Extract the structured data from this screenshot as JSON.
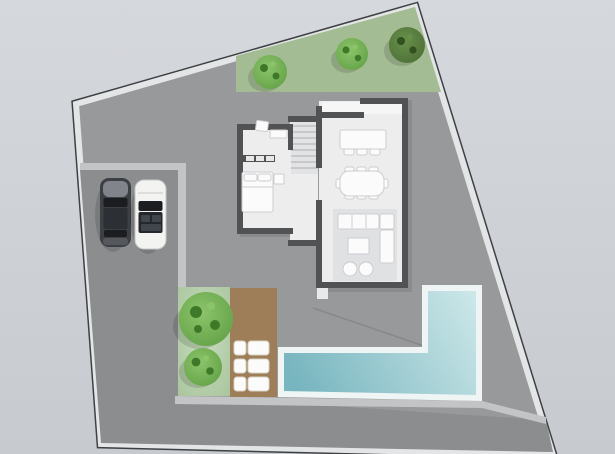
{
  "scene": {
    "name": "residential-site-plan-top-view",
    "plot": "irregular-quadrilateral-parcel",
    "house_rooms": [
      "bathroom",
      "staircase",
      "bedroom",
      "hallway",
      "kitchen",
      "dining-area",
      "living-area"
    ],
    "outdoor_objects": [
      "garden-strip",
      "driveway",
      "walkway",
      "lawn",
      "wood-deck",
      "l-shaped-pool"
    ],
    "tree_count_top_strip": 3,
    "tree_count_lawn": 2,
    "sun_lounger_count": 3,
    "car_count": 2,
    "cars": [
      "dark-car",
      "white-car"
    ]
  },
  "palette": {
    "bg_top": "#d5d8dc",
    "bg_bottom": "#c7cbd0",
    "plot_fill": "#97999b",
    "plot_wall_light": "#e4e5e6",
    "plot_wall_dark": "#3e4144",
    "garden_green": "#a4bc93",
    "lawn_light": "#c8dcbf",
    "lawn_dark": "#a9c59d",
    "tree_base": "#5f9e43",
    "tree_light": "#8cc46a",
    "tree_speck": "#3e7829",
    "dtree_base": "#4a6b34",
    "dtree_light": "#68904b",
    "dtree_speck": "#32501f",
    "driveway": "#8b8d8f",
    "walkway": "#c3c4c6",
    "deck_brown": "#9d7e58",
    "lounger_white": "#fbfbf9",
    "lounger_edge": "#d8d2c6",
    "pool_border": "#eff5f5",
    "water_light": "#cfe9ea",
    "water_deep": "#77b5bf",
    "house_wall": "#515254",
    "floor": "#ededee",
    "floor_stairs": "#e2e3e4",
    "stair_tread": "#b8b9bb",
    "rug": "#e0e1e3",
    "furn_white": "#fbfbfb",
    "furn_edge": "#cccdd0",
    "counter_white": "#f6f6f6",
    "step_white": "#e9e9ea",
    "car_dark_body": "#3c3f44",
    "car_dark_hood": "#81858b",
    "car_dark_mid": "#2c2f33",
    "car_dark_trunk": "#55585d",
    "car_glass": "#1b1d21",
    "car_white_body": "#f3f3f1",
    "car_white_edge": "#c7c8c6",
    "car_interior": "#24272c",
    "car_seat": "#41454c",
    "shadow": "rgba(0,0,0,0.13)",
    "shadow_soft": "rgba(0,0,0,0.09)",
    "seam": "rgba(60,60,60,0.18)",
    "closet_knob": "#e8e8e8"
  }
}
